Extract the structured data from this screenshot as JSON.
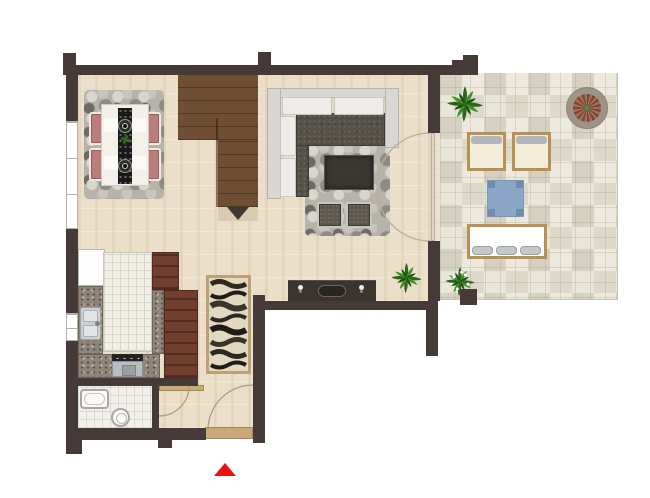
{
  "plan": {
    "title": "Apartment floor plan with terrace",
    "rooms": [
      {
        "name": "Living room",
        "items": [
          "L-shaped sectional sofa with dark gray seat cushions",
          "gray pebble rug",
          "dark wood coffee table",
          "two upholstered ottomans",
          "media sideboard with two candlesticks and a bowl",
          "potted plant",
          "double French doors to terrace"
        ]
      },
      {
        "name": "Dining area",
        "items": [
          "white dining table with black runner",
          "two decorative plates",
          "small centerpiece plant",
          "four pink upholstered chairs",
          "gray pebble rug"
        ]
      },
      {
        "name": "Staircase",
        "items": [
          "dark wood stairs",
          "direction arrow pointing down"
        ]
      },
      {
        "name": "Kitchen",
        "items": [
          "refrigerator",
          "white tiled island counter",
          "granite L-shaped countertop",
          "double stainless-steel sink",
          "cooktop with oven",
          "tall reddish-wood cabinets"
        ]
      },
      {
        "name": "Hallway",
        "items": [
          "wave-patterned runner rug",
          "wood threshold",
          "entrance doormat",
          "entrance door swing",
          "bathroom door swing"
        ]
      },
      {
        "name": "Bathroom",
        "items": [
          "bathtub",
          "toilet",
          "white tile floor"
        ]
      },
      {
        "name": "Terrace",
        "items": [
          "stone mosaic paving",
          "palm plant",
          "round mosaic planter",
          "two wood-frame armchairs",
          "blue square side table",
          "wood-frame bench with three gray cushions",
          "white flowering plant"
        ]
      }
    ],
    "markers": [
      {
        "name": "entrance-arrow",
        "description": "red triangle pointing up at the main entrance"
      },
      {
        "name": "stairs-arrow",
        "description": "dark triangle at staircase base pointing down"
      }
    ],
    "colors": {
      "wall": "#463a39",
      "wood_floor": "#ecdfc9",
      "stair_wood": "#6f4f33",
      "terrace_tile": "#e6e2d5",
      "rug_gray": "#b7b3ab",
      "sofa_seat": "#56524a",
      "chair_pink": "#bb7d7a",
      "cabinet_wood": "#713f2d",
      "granite": "#8e867a",
      "accent_blue": "#8ca6c7",
      "trim_tan": "#b69055",
      "plant_green": "#2a661c",
      "entrance_red": "#e81414"
    }
  }
}
